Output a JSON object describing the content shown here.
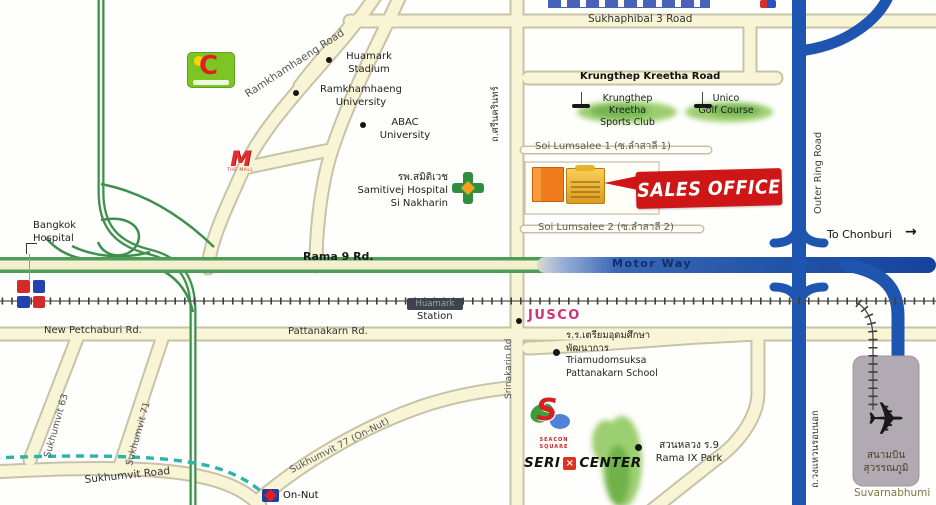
{
  "roads": {
    "sukhaphibal3": "Sukhaphibal 3 Road",
    "ramkhamhaeng": "Ramkhamhaeng Road",
    "krungthep_kreetha": "Krungthep Kreetha Road",
    "rama9": "Rama 9 Rd.",
    "motorway": "Motor Way",
    "outer_ring_en": "Outer Ring Road",
    "outer_ring_th": "ถ.วงแหวนรอบนอก",
    "new_petchaburi": "New Petchaburi Rd.",
    "pattanakarn": "Pattanakarn Rd.",
    "sukhumvit_63": "Sukhumvit 63",
    "sukhumvit_71": "Sukhumvit 71",
    "sukhumvit_77": "Sukhumvit 77 (On-Nut)",
    "sukhumvit_road": "Sukhumvit Road",
    "srinakarin_th": "ถ.ศรีนครินทร์",
    "srinakarin_en": "Srinakarin Rd",
    "soi_lumsalee_1": "Soi Lumsalee 1 (ซ.ลำสาลี 1)",
    "soi_lumsalee_2": "Soi Lumsalee 2 (ซ.ลำสาลี 2)",
    "to_chonburi": "To Chonburi"
  },
  "places": {
    "huamark_stadium": "Huamark\nStadium",
    "ramkhamhaeng_university": "Ramkhamhaeng\nUniversity",
    "abac_university": "ABAC\nUniversity",
    "samitivej_hospital": "รพ.สมิติเวช\nSamitivej Hospital\nSi Nakharin",
    "bangkok_hospital": "Bangkok\nHospital",
    "krungthep_kreetha_sports_club": "Krungthep\nKreetha\nSports Club",
    "unico_golf_course": "Unico\nGolf Course",
    "huamark_station": "Huamark",
    "station": "Station",
    "jusco": "JUSCO",
    "pattanakarn_school": "ร.ร.เตรียมอุดมศึกษา\nพัฒนาการ\nTriamudomsuksa\nPattanakarn School",
    "rama9_park": "สวนหลวง ร.9\nRama IX Park",
    "airport_th": "สนามบิน\nสุวรรณภูมิ",
    "airport_en": "Suvarnabhumi",
    "on_nut": "On-Nut"
  },
  "sales_office": {
    "label": "SALES OFFICE"
  },
  "logos": {
    "big_c_letter": "C",
    "the_mall_letter": "M",
    "the_mall_text": "THE MALL",
    "seacon_letter": "S",
    "seacon_text": "SEACON\nSQUARE",
    "seri": "SERI",
    "center": "CENTER",
    "seri_x": "×"
  },
  "icons": {
    "arrow_right": "→",
    "plane": "✈"
  },
  "colors": {
    "road_fill": "#f8f4d6",
    "road_casing": "#c8c3a6",
    "expressway_green": "#3f8f4f",
    "rama9_green": "#4d9d58",
    "motorway_blue": "#16439c",
    "ring_blue": "#1e55b0",
    "rail_dark": "#3f3f3f",
    "bts_teal": "#2fb2aa",
    "sales_red": "#cf1616",
    "jusco_pink": "#cf2f7f",
    "grass_green": "#9ccf70",
    "airport_gray": "#b2aab2"
  }
}
